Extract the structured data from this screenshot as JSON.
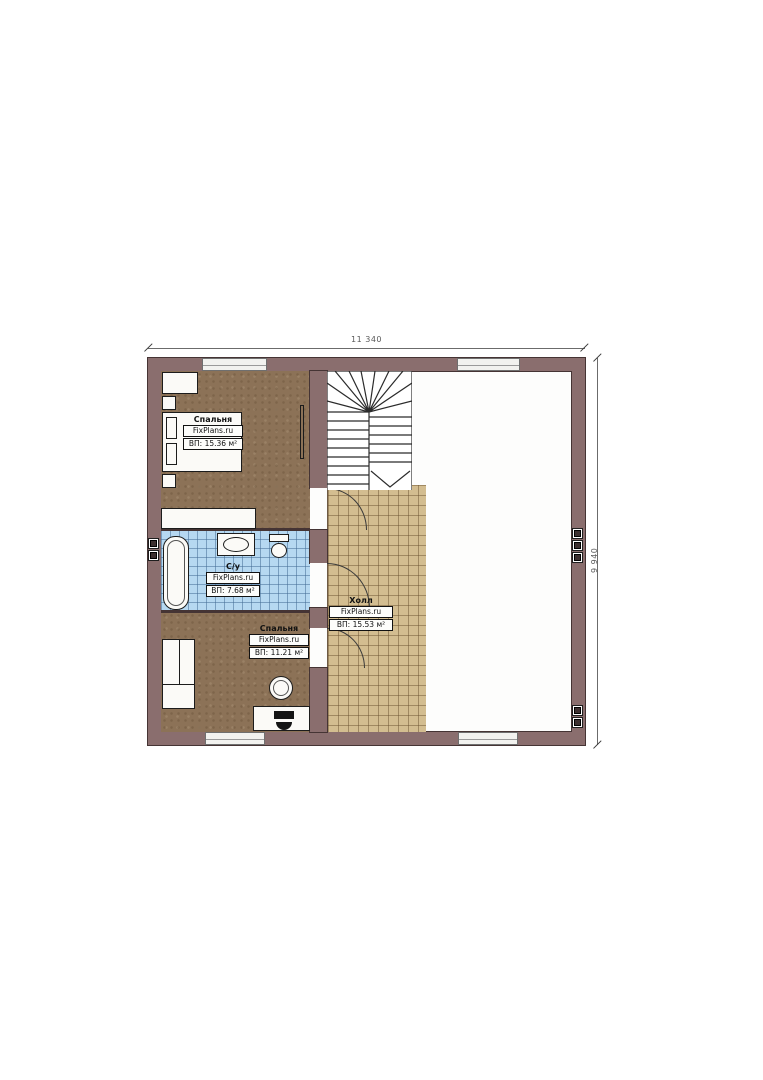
{
  "plan": {
    "title": "second-floor plan",
    "dimensions": {
      "width_label": "11 340",
      "height_label": "9 940"
    },
    "rooms": {
      "bedroom_top": {
        "name": "Спальня",
        "site": "FixPlans.ru",
        "area": "ВП: 15.36 м²"
      },
      "bathroom": {
        "name": "С/у",
        "site": "FixPlans.ru",
        "area": "ВП: 7.68 м²"
      },
      "bedroom_bottom": {
        "name": "Спальня",
        "site": "FixPlans.ru",
        "area": "ВП: 11.21 м²"
      },
      "hall": {
        "name": "Холл",
        "site": "FixPlans.ru",
        "area": "ВП: 15.53 м²"
      }
    },
    "colors": {
      "wall": "#8a6e6e",
      "wall_outline": "#453434",
      "bedroom_floor": "#8c7257",
      "bathroom_tile": "#b6d8f1",
      "hall_tile": "#d3bd90",
      "window": "#f2f2ef"
    },
    "icons": [
      "bed-icon",
      "wardrobe-icon",
      "dresser-icon",
      "nightstand-icon",
      "radiator-icon",
      "bathtub-icon",
      "sink-icon",
      "toilet-icon",
      "stool-icon",
      "desk-icon",
      "laptop-icon",
      "stairs-icon",
      "door-arc-icon",
      "vent-icon",
      "window-icon",
      "dimension-arrow-icon"
    ]
  }
}
